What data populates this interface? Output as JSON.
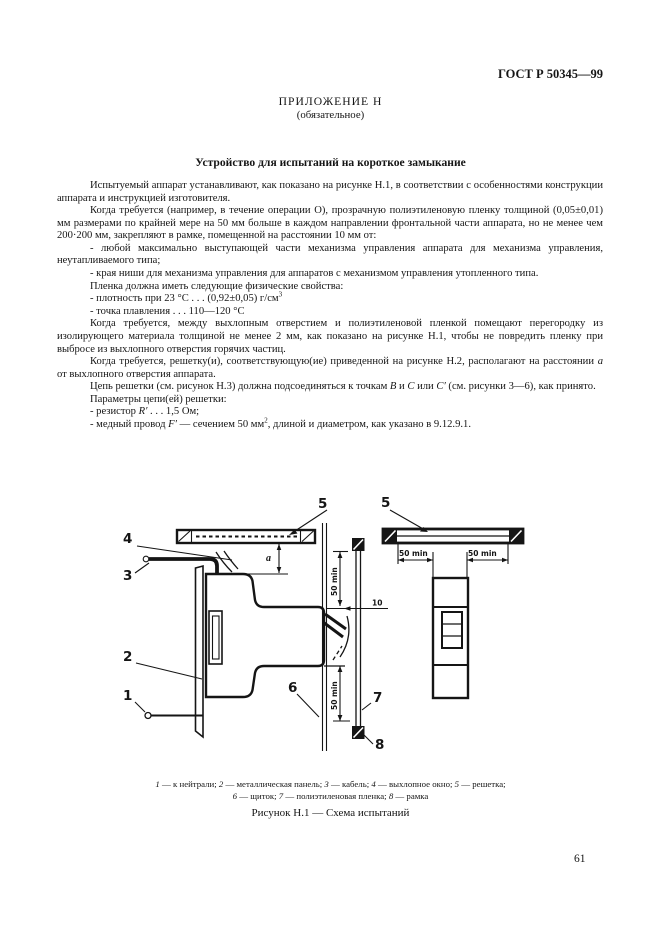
{
  "page": {
    "header_right": "ГОСТ Р 50345—99",
    "appendix_title": "ПРИЛОЖЕНИЕ Н",
    "appendix_subtitle": "(обязательное)",
    "section_title": "Устройство для испытаний на короткое замыкание",
    "page_number": "61"
  },
  "body": {
    "paragraphs": [
      {
        "segments": [
          {
            "t": "Испытуемый аппарат устанавливают, как показано на рисунке Н.1, в соответствии с особенностями конструкции аппарата и инструкцией изготовителя."
          }
        ]
      },
      {
        "segments": [
          {
            "t": "Когда требуется (например, в течение операции О), прозрачную полиэтиленовую пленку толщиной (0,05±0,01) мм размерами по крайней мере на 50 мм больше в каждом направлении фронтальной части аппарата, но не менее чем 200·200 мм, закрепляют в рамке, помещенной на расстоянии 10 мм от:"
          }
        ]
      },
      {
        "segments": [
          {
            "t": "- любой максимально выступающей части механизма управления аппарата для механизма управления, неутапливаемого типа;"
          }
        ]
      },
      {
        "segments": [
          {
            "t": "- края ниши для механизма управления для аппаратов с механизмом управления утопленного типа."
          }
        ]
      },
      {
        "segments": [
          {
            "t": "Пленка должна иметь следующие физические свойства:"
          }
        ]
      },
      {
        "segments": [
          {
            "t": "- плотность при 23 °С . . . (0,92±0,05) г/см"
          },
          {
            "t": "3",
            "sup": true
          }
        ]
      },
      {
        "segments": [
          {
            "t": "- точка плавления . . . 110—120 °С"
          }
        ]
      },
      {
        "segments": [
          {
            "t": "Когда требуется, между выхлопным отверстием и полиэтиленовой пленкой помещают перегородку из изолирующего материала толщиной не менее 2 мм, как показано на рисунке Н.1, чтобы не повредить пленку при выбросе из выхлопного отверстия горячих частиц."
          }
        ]
      },
      {
        "segments": [
          {
            "t": "Когда требуется, решетку(и), соответствующую(ие) приведенной на рисунке Н.2, располагают на расстоянии "
          },
          {
            "t": "а",
            "i": true
          },
          {
            "t": " от выхлопного отверстия аппарата."
          }
        ]
      },
      {
        "segments": [
          {
            "t": "Цепь решетки (см. рисунок Н.3) должна подсоединяться к точкам "
          },
          {
            "t": "В",
            "i": true
          },
          {
            "t": " и "
          },
          {
            "t": "С",
            "i": true
          },
          {
            "t": " или "
          },
          {
            "t": "С′",
            "i": true
          },
          {
            "t": " (см. рисунки 3—6), как принято."
          }
        ]
      },
      {
        "segments": [
          {
            "t": "Параметры цепи(ей) решетки:"
          }
        ]
      },
      {
        "segments": [
          {
            "t": "- резистор "
          },
          {
            "t": "R′",
            "i": true
          },
          {
            "t": " . . . 1,5 Ом;"
          }
        ]
      },
      {
        "segments": [
          {
            "t": "- медный провод "
          },
          {
            "t": "F′",
            "i": true
          },
          {
            "t": " — сечением 50 мм"
          },
          {
            "t": "2",
            "sup": true
          },
          {
            "t": ", длиной и диаметром, как указано в 9.12.9.1."
          }
        ]
      }
    ]
  },
  "figure": {
    "labels": {
      "c1": "1",
      "c2": "2",
      "c3": "3",
      "c4": "4",
      "c5l": "5",
      "c5r": "5",
      "c6": "6",
      "c7": "7",
      "c8": "8",
      "dim_a": "a",
      "dim_10": "10",
      "dim50_top": "50 min",
      "dim50_bottom": "50 min",
      "dim50_left": "50 min",
      "dim50_right": "50 min"
    },
    "legend_separator": " — ",
    "legend_lines": [
      [
        {
          "num": "1",
          "text": "к нейтрали;"
        },
        {
          "num": "2",
          "text": "металлическая панель;"
        },
        {
          "num": "3",
          "text": "кабель;"
        },
        {
          "num": "4",
          "text": "выхлопное окно;"
        },
        {
          "num": "5",
          "text": "решетка;"
        }
      ],
      [
        {
          "num": "6",
          "text": "щиток;"
        },
        {
          "num": "7",
          "text": "полиэтиленовая пленка;"
        },
        {
          "num": "8",
          "text": "рамка"
        }
      ]
    ],
    "caption": "Рисунок Н.1 — Схема испытаний"
  },
  "colors": {
    "ink": "#151515",
    "paper": "#ffffff"
  }
}
